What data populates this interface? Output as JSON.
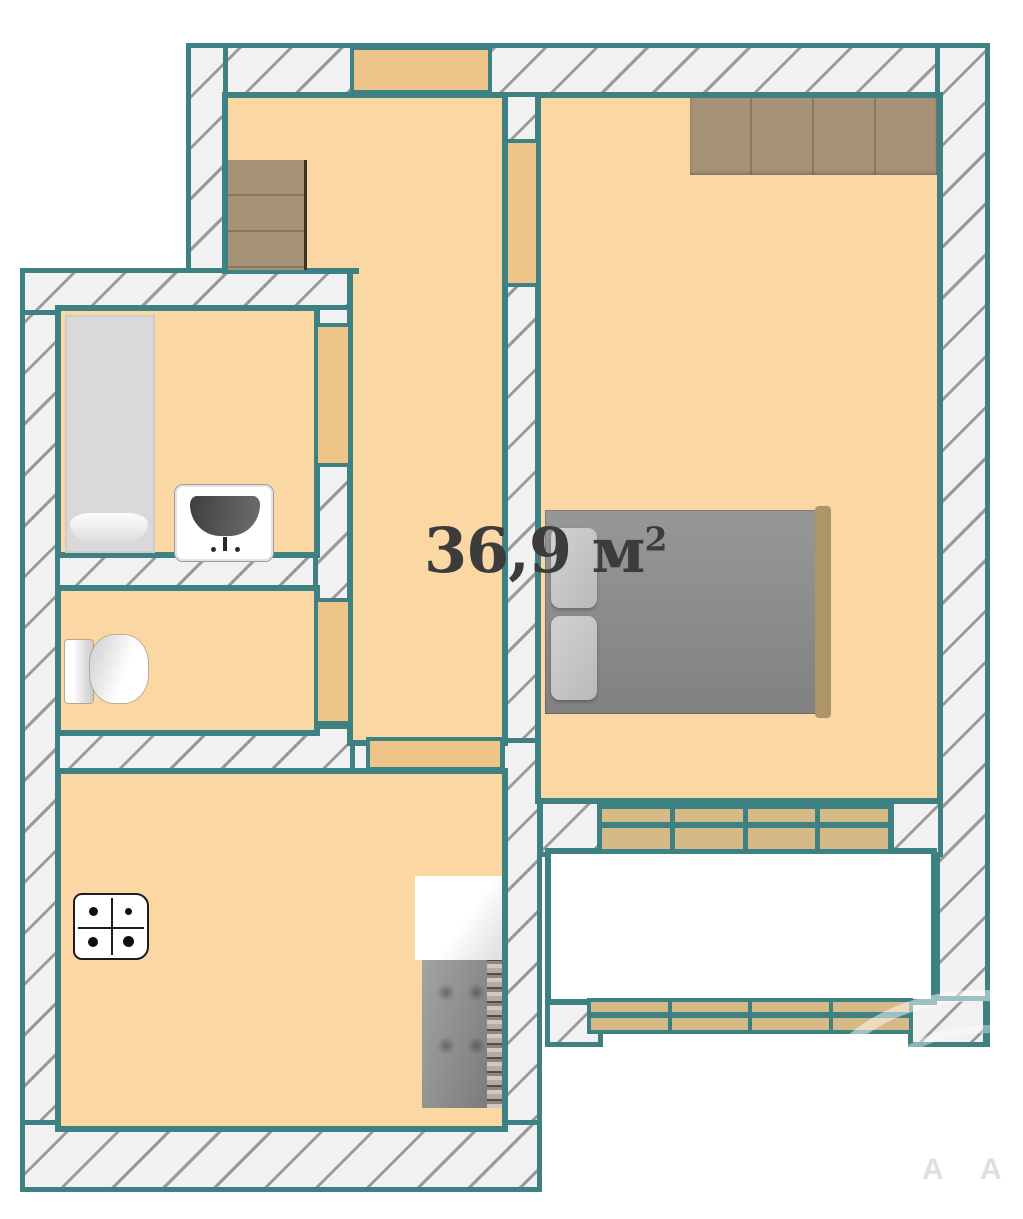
{
  "area_label": {
    "value": "36,9",
    "unit": "м",
    "superscript": "2"
  },
  "watermark": {
    "letters": [
      "A",
      "A"
    ]
  },
  "colors": {
    "teal": "#3e8183",
    "floor": "#fbd7a4",
    "door-fill": "#eec489",
    "hatch-bg": "#f1f1f1",
    "hatch-line": "#9a9a9a",
    "window-tan": "#d5b987",
    "wood": "#a69277",
    "balcony-white": "#ffffff",
    "label-color": "#3c3c3c"
  }
}
